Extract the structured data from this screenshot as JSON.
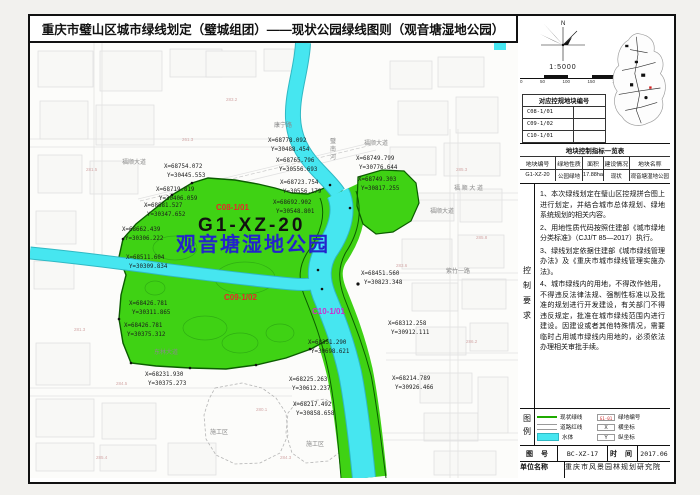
{
  "title": "重庆市璧山区城市绿线划定（璧城组团）——现状公园绿线图则（观音塘湿地公园）",
  "colors": {
    "park_green": "#3fd214",
    "water": "#46e6f0",
    "park_outline": "#0b5c00",
    "legend_green": "#1faa00"
  },
  "map": {
    "plot_labels": [
      {
        "text": "C08-1/01",
        "px": 186,
        "py": 167,
        "color": "#e8262b",
        "size": 8,
        "ls": 0
      },
      {
        "text": "G1-XZ-20",
        "px": 168,
        "py": 188,
        "color": "#111111",
        "size": 19,
        "ls": 3
      },
      {
        "text": "观音塘湿地公园",
        "px": 146,
        "py": 208,
        "color": "#2323cc",
        "size": 20,
        "ls": 2
      },
      {
        "text": "C09-1/02",
        "px": 194,
        "py": 257,
        "color": "#e8262b",
        "size": 8,
        "ls": 0
      },
      {
        "text": "C10-1/01",
        "px": 282,
        "py": 271,
        "color": "#cf2bcf",
        "size": 8,
        "ls": 0
      }
    ],
    "coordinate_labels": [
      {
        "x_val": "X=68778.092",
        "y_val": "Y=30488.454",
        "px": 238,
        "py": 99
      },
      {
        "x_val": "X=68765.796",
        "y_val": "Y=30556.693",
        "px": 246,
        "py": 119
      },
      {
        "x_val": "X=68754.072",
        "y_val": "Y=30445.553",
        "px": 134,
        "py": 125
      },
      {
        "x_val": "X=68723.754",
        "y_val": "Y=30556.179",
        "px": 250,
        "py": 141
      },
      {
        "x_val": "X=68719.819",
        "y_val": "Y=30406.059",
        "px": 126,
        "py": 148
      },
      {
        "x_val": "X=68692.902",
        "y_val": "Y=30548.801",
        "px": 243,
        "py": 161
      },
      {
        "x_val": "X=68749.799",
        "y_val": "Y=30776.644",
        "px": 326,
        "py": 117
      },
      {
        "x_val": "X=68749.303",
        "y_val": "Y=30817.255",
        "px": 328,
        "py": 138
      },
      {
        "x_val": "X=68681.527",
        "y_val": "Y=30347.652",
        "px": 114,
        "py": 164
      },
      {
        "x_val": "X=68662.439",
        "y_val": "Y=30306.222",
        "px": 92,
        "py": 188
      },
      {
        "x_val": "X=68511.604",
        "y_val": "Y=30309.834",
        "px": 96,
        "py": 216
      },
      {
        "x_val": "X=68426.781",
        "y_val": "Y=30311.865",
        "px": 99,
        "py": 262
      },
      {
        "x_val": "X=68426.781",
        "y_val": "Y=30375.312",
        "px": 94,
        "py": 284
      },
      {
        "x_val": "X=68231.930",
        "y_val": "Y=30375.273",
        "px": 115,
        "py": 333
      },
      {
        "x_val": "X=68451.560",
        "y_val": "Y=30823.348",
        "px": 331,
        "py": 232
      },
      {
        "x_val": "X=68351.290",
        "y_val": "Y=30698.621",
        "px": 278,
        "py": 301
      },
      {
        "x_val": "X=68312.258",
        "y_val": "Y=30912.111",
        "px": 358,
        "py": 282
      },
      {
        "x_val": "X=68225.263",
        "y_val": "Y=30612.237",
        "px": 259,
        "py": 338
      },
      {
        "x_val": "X=68217.492",
        "y_val": "Y=30858.658",
        "px": 263,
        "py": 363
      },
      {
        "x_val": "X=68214.789",
        "y_val": "Y=30926.466",
        "px": 362,
        "py": 337
      }
    ],
    "road_labels": [
      {
        "text": "康宁路",
        "px": 244,
        "py": 84
      },
      {
        "text": "福顺大道",
        "px": 92,
        "py": 121
      },
      {
        "text": "福顺大道",
        "px": 334,
        "py": 102
      },
      {
        "text": "福 顺 大 道",
        "px": 424,
        "py": 147
      },
      {
        "text": "福顺大道",
        "px": 400,
        "py": 170
      },
      {
        "text": "东林大道",
        "px": 124,
        "py": 311
      },
      {
        "text": "紫竹一路",
        "px": 416,
        "py": 230
      },
      {
        "text": "施工区",
        "px": 180,
        "py": 391
      },
      {
        "text": "施工区",
        "px": 276,
        "py": 403
      },
      {
        "text": "璧南河",
        "px": 300,
        "py": 100,
        "vertical": true
      }
    ],
    "faint_labels": [
      {
        "text": "281.5",
        "px": 56,
        "py": 128
      },
      {
        "text": "283.2",
        "px": 196,
        "py": 58
      },
      {
        "text": "261.3",
        "px": 152,
        "py": 98
      },
      {
        "text": "285.3",
        "px": 426,
        "py": 128
      },
      {
        "text": "285.8",
        "px": 446,
        "py": 196
      },
      {
        "text": "283.6",
        "px": 366,
        "py": 224
      },
      {
        "text": "281.3",
        "px": 44,
        "py": 288
      },
      {
        "text": "286.2",
        "px": 436,
        "py": 300
      },
      {
        "text": "284.5",
        "px": 86,
        "py": 342
      },
      {
        "text": "280.1",
        "px": 226,
        "py": 368
      },
      {
        "text": "285.4",
        "px": 66,
        "py": 416
      },
      {
        "text": "284.3",
        "px": 250,
        "py": 416
      }
    ]
  },
  "sidebar": {
    "north_label": "N",
    "scale_text": "1:5000",
    "scale_ticks": [
      "0",
      "50",
      "100",
      "150",
      "200"
    ],
    "plot_table": {
      "title": "对应控规地块编号",
      "rows": [
        "C08-1/01",
        "C09-1/02",
        "C10-1/01"
      ]
    },
    "control_table": {
      "title": "地块控制指标一览表",
      "headers": [
        "地块编号",
        "绿地性质",
        "面积",
        "建设情况",
        "地块名称"
      ],
      "rows": [
        [
          "G1-XZ-20",
          "公园绿地",
          "17.88ha",
          "现状",
          "观音塘湿地公园"
        ]
      ]
    },
    "requirements": {
      "label": "控制要求",
      "items": [
        "1、本次绿线划定在璧山区控规拼合图上进行划定，并结合城市总体规划、绿地系统规划的相关内容。",
        "2、用地性质代码按照住建部《城市绿地分类标准》（CJJ/T 85—2017）执行。",
        "3、绿线划定依据住建部《城市绿线管理办法》及《重庆市城市绿线管理实施办法》。",
        "4、城市绿线内的用地，不得改作他用，不得违反法律法规、强制性标准以及批准的规划进行开发建设，有关部门不得违反规定，批准在城市绿线范围内进行建设。因建设或者其他特殊情况，需要临时占用城市绿线内用地的，必须依法办理相关审批手续。"
      ]
    },
    "legend": {
      "label": "图例",
      "items_left": [
        {
          "symbol": "greenline",
          "text": "现状绿线"
        },
        {
          "symbol": "roadline",
          "text": "道路红线"
        },
        {
          "symbol": "water",
          "text": "水体"
        }
      ],
      "items_right": [
        {
          "symbol": "code",
          "symbol_text": "G1-01",
          "text": "绿地编号"
        },
        {
          "symbol": "box",
          "symbol_text": "X",
          "text": "横坐标"
        },
        {
          "symbol": "box",
          "symbol_text": "Y",
          "text": "纵坐标"
        }
      ]
    },
    "titleblock": {
      "drawing_no_label": "图 号",
      "drawing_no": "BC-XZ-17",
      "date_label": "时 间",
      "date": "2017.06",
      "unit_label": "单位名称",
      "unit": "重庆市风景园林规划研究院"
    }
  }
}
